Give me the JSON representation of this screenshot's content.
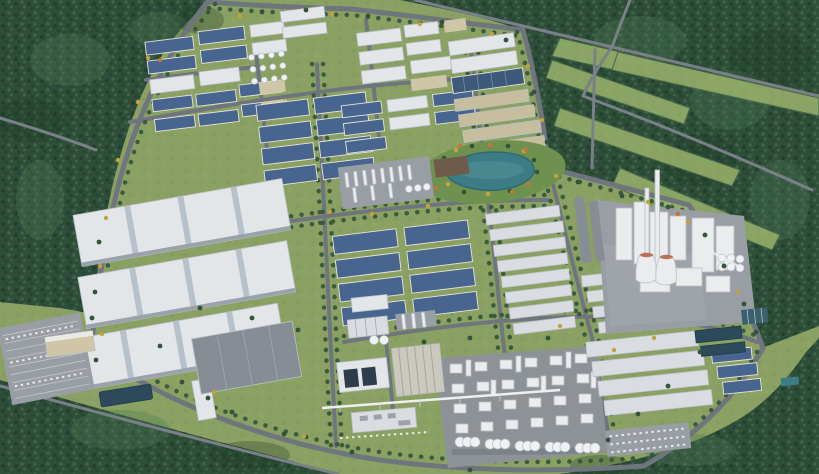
{
  "meta": {
    "alt": "Aerial 3D rendering of a master-planned industrial park bordered by dense forest: grids of blue-roofed and white-roofed factory halls, a central landscaped lake, a white process plant with chimneys and cooling towers, a chemical unit with tank rows, warehouses, parking lots and tree-lined roads."
  },
  "colors": {
    "terrain": "#8BA163",
    "lawn": "#6E9150",
    "field": "#9AB36C",
    "forest": "#2E4E3A",
    "tree": "#33543B",
    "tree_yellow": "#C0A23E",
    "tree_orange": "#BC7A35",
    "road": "#6F757C",
    "road_minor": "#7A8087",
    "roof_blue": "#47658E",
    "roof_solar": "#3E5A7A",
    "roof_white": "#E3E6E9",
    "roof_light": "#D9DDE1",
    "roof_gray": "#878D95",
    "roof_tan": "#C7BD9F",
    "wall_beige": "#CFC5A7",
    "roof_brown": "#6F5B49",
    "panel_dark": "#2E3D4A",
    "pad": "#999EA4",
    "pad_dark": "#8D9297",
    "plant_white": "#EAECEE",
    "water": "#3C7D85",
    "water_dark": "#2C4A5C",
    "rim_red": "#BD7257",
    "ribbed_tan": "#CBC8BD"
  },
  "scene": {
    "regions": [
      "northwest-forest",
      "northeast-forest-with-fields",
      "south-forest-belt",
      "southeast-forest",
      "ring-road",
      "northwest-factory-cluster",
      "blue-roof-warehouse-grid",
      "north-central-factory-cluster",
      "east-tan-warehouse-rows",
      "landscaped-lake-park",
      "large-white-logistics-sheds",
      "gray-roof-hall",
      "west-parking-lot",
      "retention-pond",
      "process-column-yard",
      "central-blue-warehouse-rows",
      "white-warehouse-rows",
      "cement-plant-with-chimneys-and-cooling-towers",
      "chemical-plant-with-silos",
      "utility-cluster-with-pipe-bridge",
      "southeast-warehouse-rows",
      "water-treatment-basins",
      "southeast-parking-lot"
    ]
  }
}
